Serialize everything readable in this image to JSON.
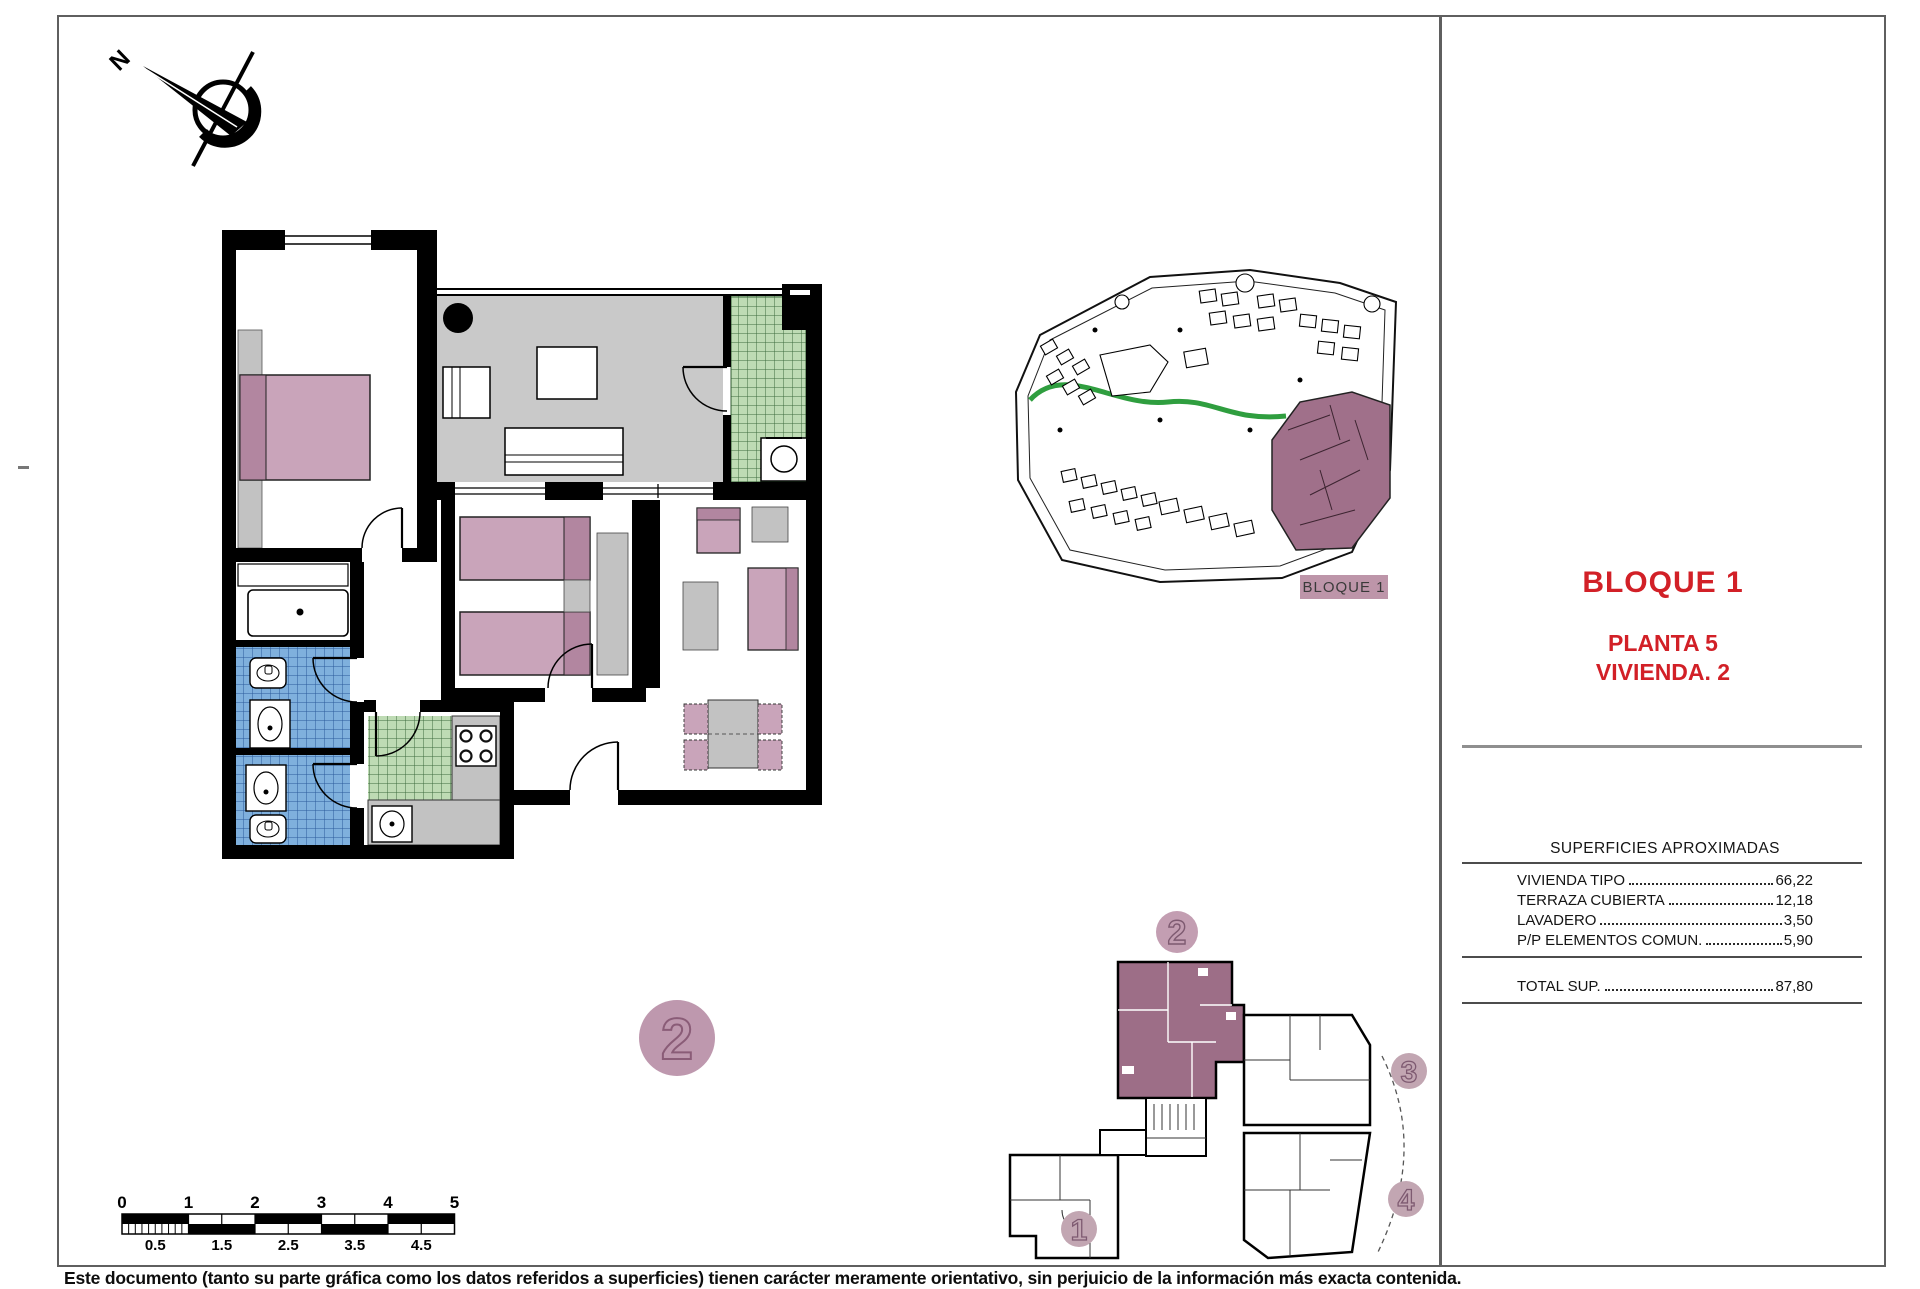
{
  "title_block": {
    "block": "BLOQUE 1",
    "floor": "PLANTA 5",
    "unit": "VIVIENDA. 2"
  },
  "areas_table": {
    "header": "SUPERFICIES APROXIMADAS",
    "rows": [
      {
        "label": "VIVIENDA TIPO",
        "value": "66,22"
      },
      {
        "label": "TERRAZA CUBIERTA",
        "value": "12,18"
      },
      {
        "label": "LAVADERO",
        "value": "3,50"
      },
      {
        "label": "P/P ELEMENTOS COMUN.",
        "value": "5,90"
      }
    ],
    "total": {
      "label": "TOTAL SUP.",
      "value": "87,80"
    }
  },
  "site_plan": {
    "block_label": "BLOQUE 1"
  },
  "key_plan": {
    "unit_numbers": [
      "1",
      "2",
      "3",
      "4"
    ],
    "highlighted_unit": "2"
  },
  "floor_plan": {
    "unit_badge": "2"
  },
  "compass": {
    "north_label": "N"
  },
  "scale_bar": {
    "major_labels": [
      "0",
      "1",
      "2",
      "3",
      "4",
      "5"
    ],
    "minor_labels": [
      "0.5",
      "1.5",
      "2.5",
      "3.5",
      "4.5"
    ]
  },
  "disclaimer": "Este documento (tanto su parte gráfica como los datos referidos a superficies) tienen carácter meramente orientativo, sin perjuicio de la información más exacta contenida.",
  "colors": {
    "title_red": "#d22027",
    "room_mauve": "#c9a4ba",
    "mauve_dark": "#b286a0",
    "badge_mauve": "#be98ae",
    "terrace_gray": "#c9c9c9",
    "green_tile": "#bedbb4",
    "blue_tile": "#7fb0dd",
    "wall_black": "#000000"
  }
}
